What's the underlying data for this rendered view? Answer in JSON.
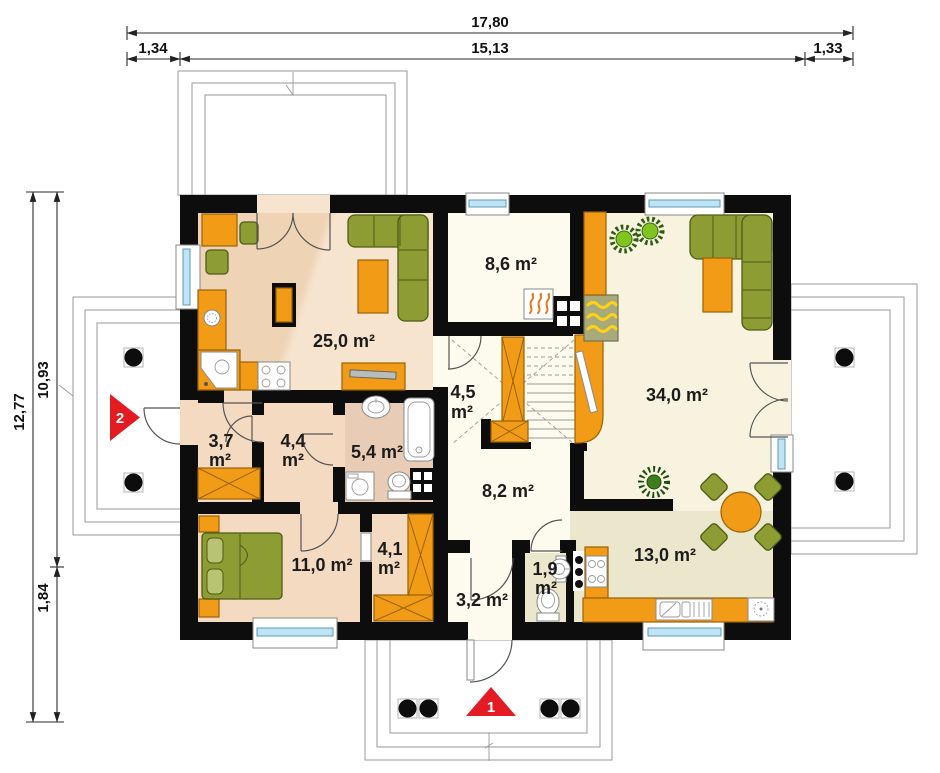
{
  "dimensions": {
    "total_width": "17,80",
    "left_offset": "1,34",
    "main_width": "15,13",
    "right_offset": "1,33",
    "total_height": "12,77",
    "main_height": "10,93",
    "porch_depth": "1,84"
  },
  "rooms": {
    "r25": "25,0 m²",
    "r86": "8,6 m²",
    "r45_1": "4,5",
    "r45_2": "m²",
    "r34": "34,0 m²",
    "r37_1": "3,7",
    "r37_2": "m²",
    "r44_1": "4,4",
    "r44_2": "m²",
    "r54": "5,4 m²",
    "r82": "8,2 m²",
    "r110": "11,0 m²",
    "r41_1": "4,1",
    "r41_2": "m²",
    "r19_1": "1,9",
    "r19_2": "m²",
    "r32": "3,2 m²",
    "r130": "13,0 m²"
  },
  "markers": {
    "entrance_main": "1",
    "entrance_side": "2"
  },
  "icons": {
    "fireplace": "flame-lines",
    "hearth": "yellow-flames-box",
    "plant": "spiky-circle",
    "stove": "four-burner-rings",
    "sink": "basin-bowl",
    "toilet": "bowl-and-tank",
    "washer": "drum-circle",
    "wardrobe": "crossed-box",
    "stairs": "treads-with-cross"
  },
  "colors": {
    "wall": "#0d0d0d",
    "orange": "#f29b17",
    "orange-border": "#9a6206",
    "green": "#8d9d33",
    "green-border": "#4d5c15",
    "red": "#e51b24",
    "glass": "#bfe4f4",
    "glass-border": "#5e9ab8",
    "floor-cream": "#fdfaee",
    "floor-cream2": "#f8f3de",
    "floor-peach": "#f3dac1",
    "floor-peach-light": "#f7e4cf",
    "floor-bath": "#e9ccb6",
    "floor-olive": "#ebe7cc",
    "outline-gray": "#9a9a9a",
    "hearth": "#a9aa7c",
    "flame-yellow": "#ffd312"
  }
}
